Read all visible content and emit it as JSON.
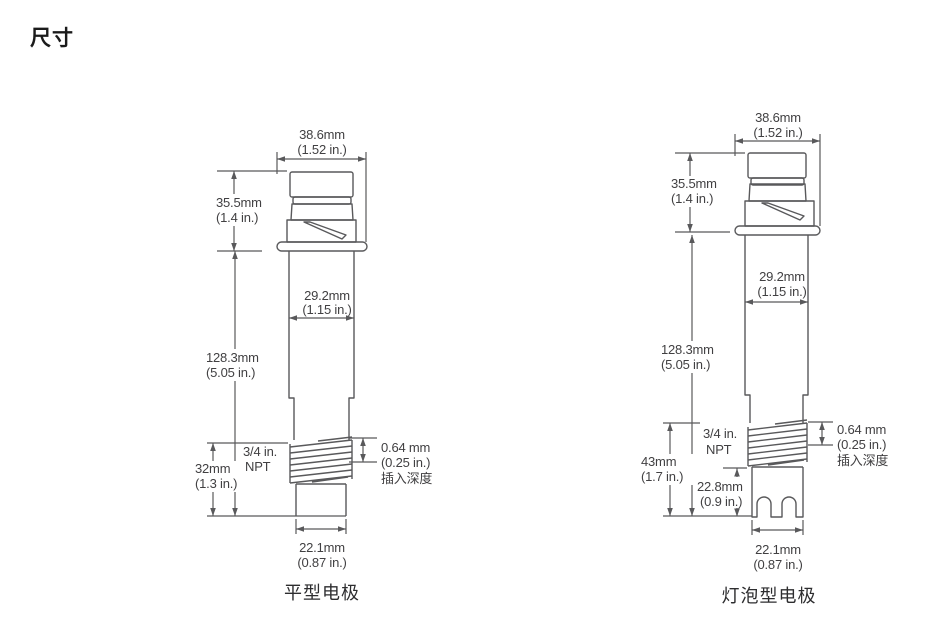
{
  "page": {
    "title": "尺寸"
  },
  "colors": {
    "line": "#59595B",
    "text": "#414042",
    "background": "#FFFFFF"
  },
  "flat": {
    "caption": "平型电极",
    "top_width_mm": "38.6mm",
    "top_width_in": "(1.52 in.)",
    "cap_height_mm": "35.5mm",
    "cap_height_in": "(1.4 in.)",
    "body_width_mm": "29.2mm",
    "body_width_in": "(1.15 in.)",
    "body_length_mm": "128.3mm",
    "body_length_in": "(5.05 in.)",
    "lower_length_mm": "32mm",
    "lower_length_in": "(1.3 in.)",
    "thread_size": "3/4 in.",
    "thread_type": "NPT",
    "insertion_mm": "0.64 mm",
    "insertion_in": "(0.25 in.)",
    "insertion_label": "插入深度",
    "tip_width_mm": "22.1mm",
    "tip_width_in": "(0.87 in.)"
  },
  "bulb": {
    "caption": "灯泡型电极",
    "top_width_mm": "38.6mm",
    "top_width_in": "(1.52 in.)",
    "cap_height_mm": "35.5mm",
    "cap_height_in": "(1.4 in.)",
    "body_width_mm": "29.2mm",
    "body_width_in": "(1.15 in.)",
    "body_length_mm": "128.3mm",
    "body_length_in": "(5.05 in.)",
    "lower_length_mm": "43mm",
    "lower_length_in": "(1.7 in.)",
    "guard_length_mm": "22.8mm",
    "guard_length_in": "(0.9 in.)",
    "thread_size": "3/4 in.",
    "thread_type": "NPT",
    "insertion_mm": "0.64 mm",
    "insertion_in": "(0.25 in.)",
    "insertion_label": "插入深度",
    "tip_width_mm": "22.1mm",
    "tip_width_in": "(0.87 in.)"
  }
}
